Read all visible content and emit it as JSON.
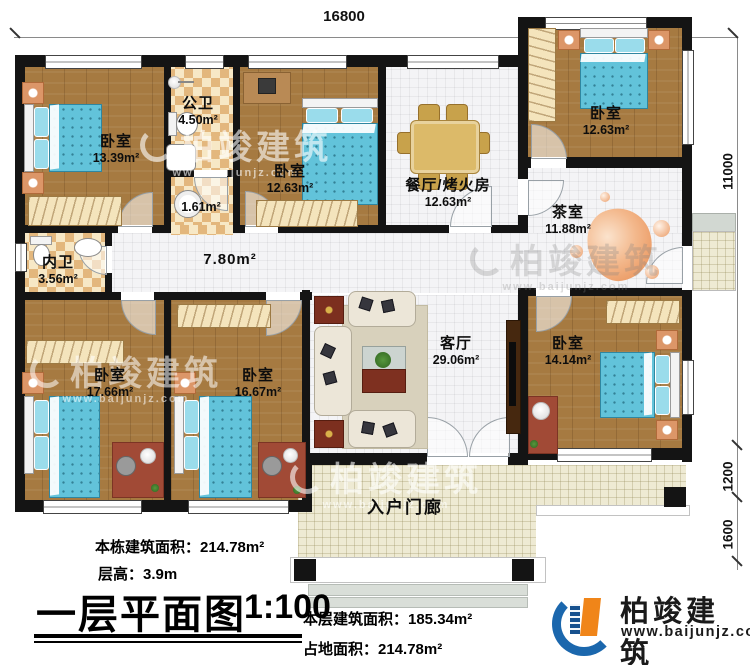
{
  "dimensions": {
    "top_width": "16800",
    "right_total": "11000",
    "right_upper": "1200",
    "right_lower": "1600"
  },
  "rooms": [
    {
      "name": "卧室",
      "area": "13.39m²"
    },
    {
      "name": "公卫",
      "area": "4.50m²"
    },
    {
      "name": "",
      "area": "1.61m²"
    },
    {
      "name": "卧室",
      "area": "12.63m²"
    },
    {
      "name": "餐厅/烤火房",
      "area": "12.63m²"
    },
    {
      "name": "卧室",
      "area": "12.63m²"
    },
    {
      "name": "茶室",
      "area": "11.88m²"
    },
    {
      "name": "内卫",
      "area": "3.56m²"
    },
    {
      "name": "",
      "area": "7.80m²"
    },
    {
      "name": "卧室",
      "area": "17.66m²"
    },
    {
      "name": "卧室",
      "area": "16.67m²"
    },
    {
      "name": "客厅",
      "area": "29.06m²"
    },
    {
      "name": "卧室",
      "area": "14.14m²"
    },
    {
      "name": "入户门廊",
      "area": ""
    }
  ],
  "info": {
    "total_building_area": "本栋建筑面积：214.78m²",
    "floor_height": "层高：3.9m",
    "floor_area": "本层建筑面积：185.34m²",
    "footprint_area": "占地面积：214.78m²"
  },
  "title": {
    "text": "一层平面图",
    "scale": "1:100"
  },
  "logo": {
    "name": "柏竣建筑",
    "url": "www.baijunjz.com"
  },
  "watermark": {
    "name": "柏竣建筑",
    "url": "www.baijunjz.com"
  },
  "colors": {
    "wall": "#141414",
    "wood": "#a67a41",
    "bed": "#62c3da",
    "logo_blue": "#1b67ad",
    "logo_orange": "#f08519"
  }
}
